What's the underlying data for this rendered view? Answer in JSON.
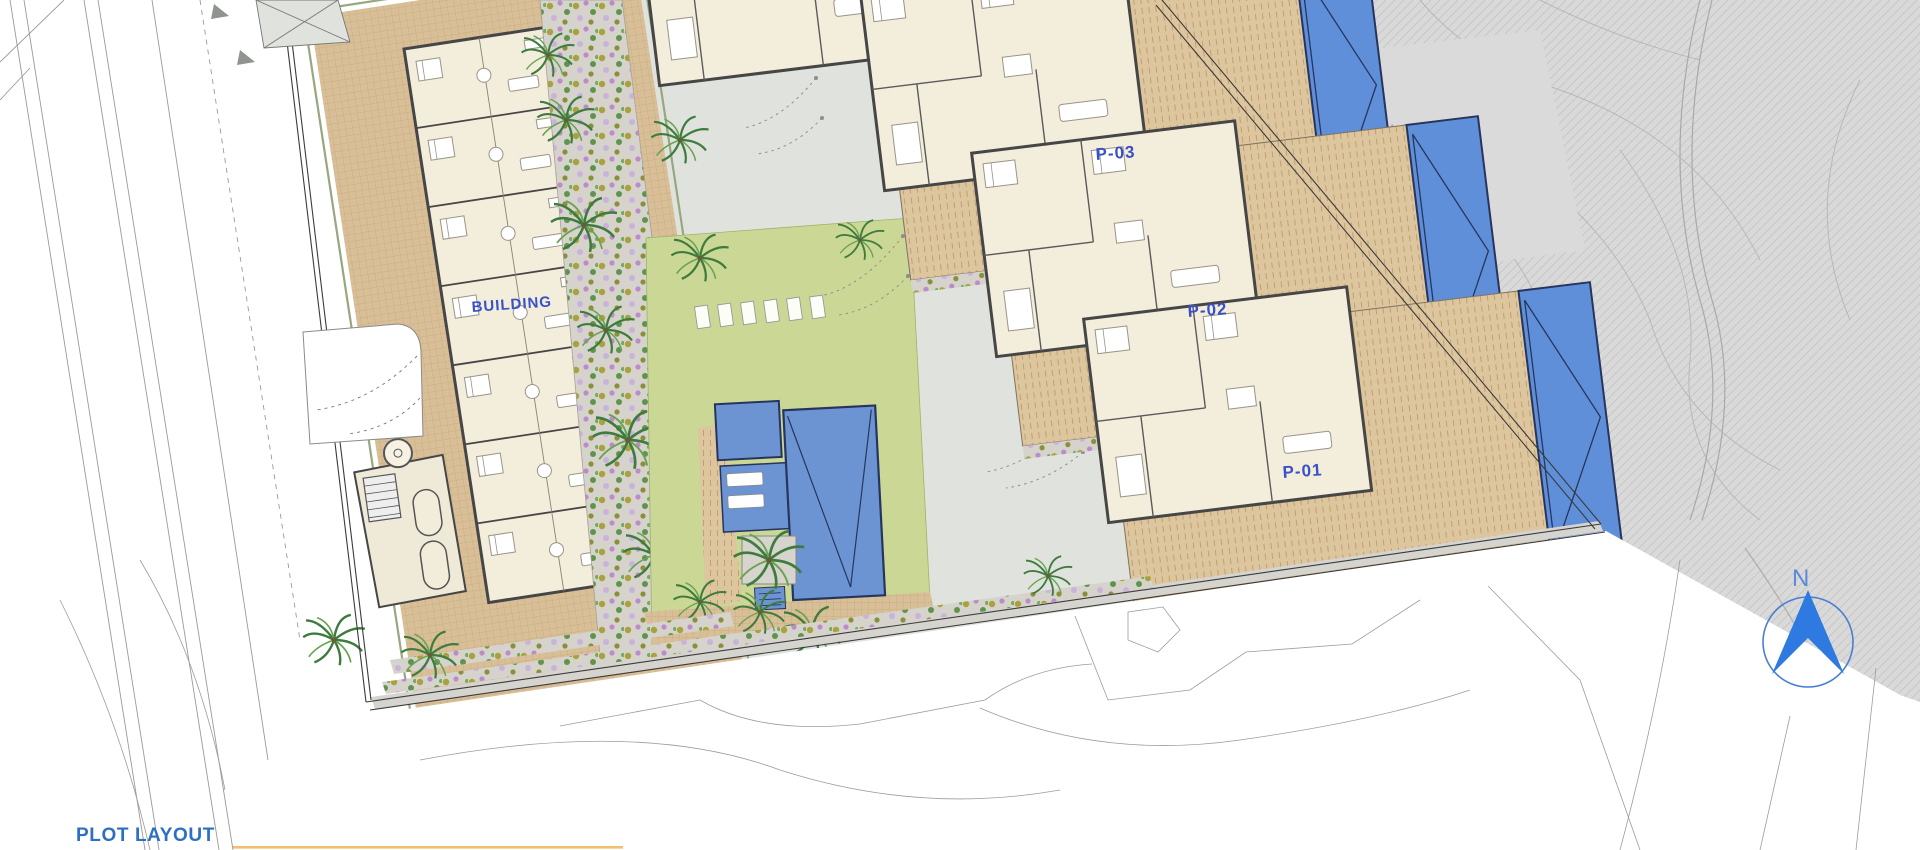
{
  "title": {
    "text": "PLOT LAYOUT"
  },
  "plan": {
    "building": {
      "label": "BUILDING"
    },
    "plots": [
      {
        "label": "P-01"
      },
      {
        "label": "P-02"
      },
      {
        "label": "P-03"
      }
    ],
    "golf": {
      "line1": "C A M P O",
      "line2": "D E",
      "line3": "G O L F"
    },
    "north": {
      "label": "N"
    },
    "colors": {
      "label_blue": "#3a50c6",
      "title_blue": "#2d70c2",
      "pool_blue": "#6d94d2",
      "villa_pool_blue": "#5e8fd8",
      "pool_border_navy": "#27355e",
      "deck_tan": "#ddc59d",
      "paving_tan": "#d8bf97",
      "floor_cream": "#f3eddc",
      "wall_grey": "#464646",
      "lawn_green": "#cbd794",
      "road_grey": "#e0e3dd",
      "golf_grey": "#d9d9d9",
      "underline_orange": "#eeb455",
      "north_blue": "#2e7ae0"
    }
  }
}
